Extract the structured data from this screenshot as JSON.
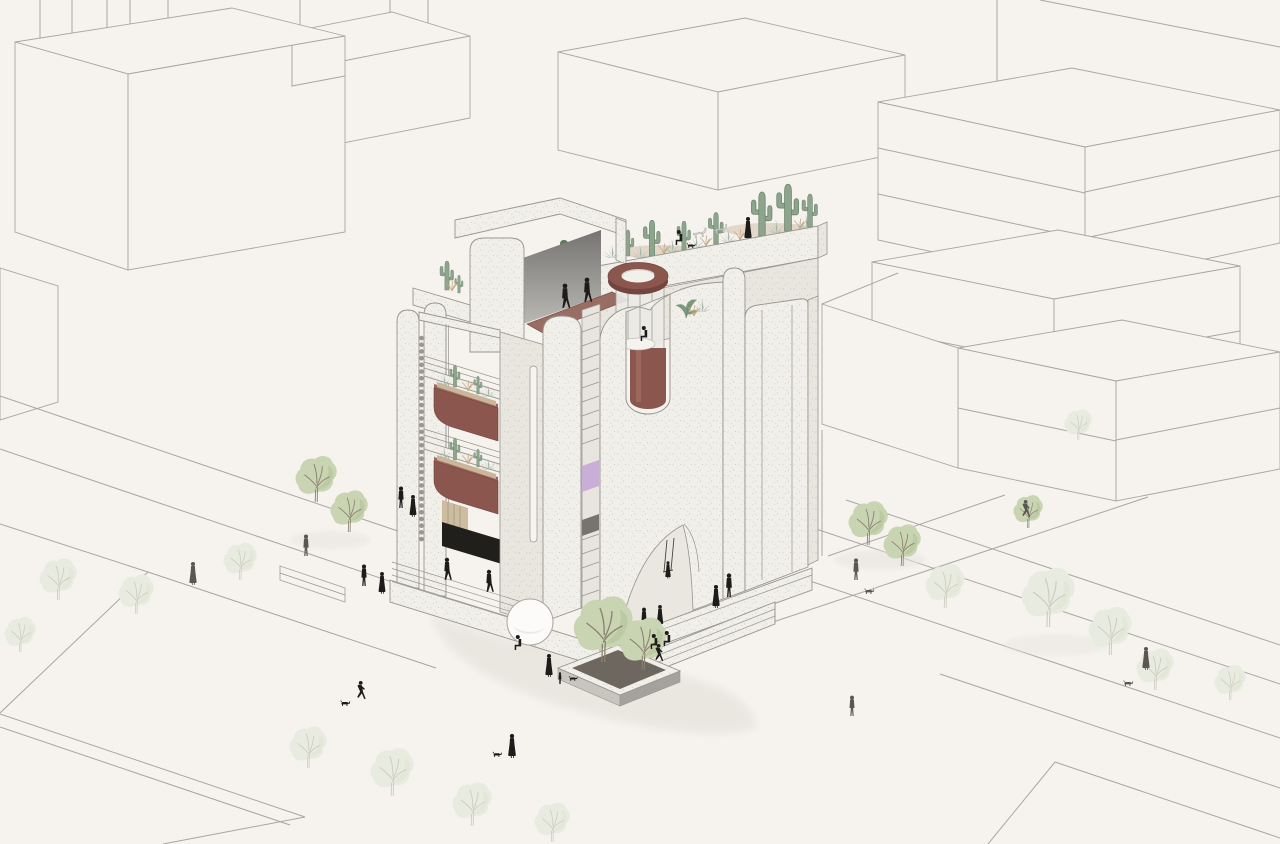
{
  "scene": {
    "kind": "architectural-axonometric-illustration",
    "description": "Hand-drawn axonometric rendering of a white stippled concept building with a rooftop cactus garden, maroon cylindrical skylight pavilion, hanging maroon cactus planters, rain chain, arched entrance and plaza, surrounded by wireframe city blocks, pale watercolor street trees and small pedestrian silhouettes",
    "style": "line render on warm off-white paper"
  },
  "palette": {
    "bg": "#f6f3ef",
    "line": "#a9a5a0",
    "line2": "#98948f",
    "wall": "#f1efe9",
    "wallsh": "#e9e6df",
    "dot": "#d7d2c8",
    "dot2": "#cbc5b8",
    "maroon": "#8a564e",
    "maroon_light": "#9d675d",
    "maroon_dark": "#73453e",
    "terrace": "#9a6d64",
    "soil": "#c9b69b",
    "tan": "#cdbc9d",
    "void": "#211f1c",
    "cactus": "#8da58c",
    "cactus_line": "#6f876e",
    "agave": "#a7b7a9",
    "grass": "#c2a981",
    "tree": "#c9d4b2",
    "tree_dark": "#afc093",
    "branch": "#8b8172",
    "tree_faint": "#e8ebdf",
    "tree_faint_dark": "#dde3d0",
    "branch_faint": "#cfccc1",
    "lilac": "#c9aed8",
    "black": "#1e1c1a",
    "gray": "#5a5751",
    "shadow": "#e7e3dc",
    "glass": "#eceae5",
    "screen_a": "#757472",
    "screen_b": "#bab8b4",
    "white": "#fbfaf7"
  },
  "inventory": {
    "planter_boxes": 2,
    "skylight_drum": 1,
    "rooftop_saguaros": 7,
    "lounge_chairs": 2,
    "sphere_sculpture": 1,
    "swing": 1,
    "rain_chain": 1,
    "pedestrians_black": 24,
    "pedestrians_gray": 6,
    "dogs": 6,
    "street_trees_green": 8,
    "street_trees_faint": 14
  }
}
